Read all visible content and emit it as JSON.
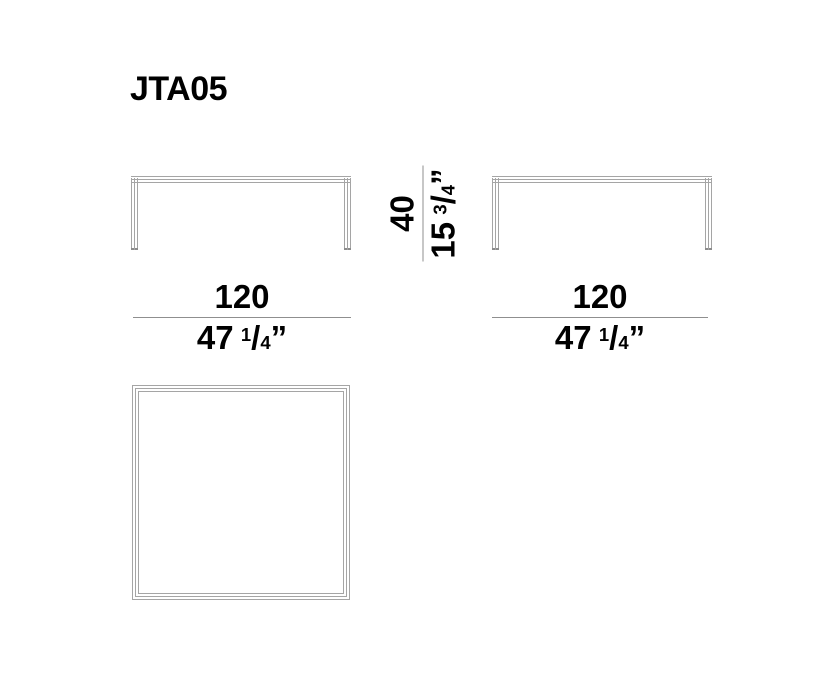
{
  "title": "JTA05",
  "dimensions": {
    "front_width": {
      "cm": "120",
      "inch_whole": "47",
      "inch_frac_num": "1",
      "inch_frac_den": "4",
      "inch_mark": "”"
    },
    "side_width": {
      "cm": "120",
      "inch_whole": "47",
      "inch_frac_num": "1",
      "inch_frac_den": "4",
      "inch_mark": "”"
    },
    "height": {
      "cm": "40",
      "inch_whole": "15",
      "inch_frac_num": "3",
      "inch_frac_den": "4",
      "inch_mark": "”"
    }
  },
  "glyphs": {
    "fraction_slash": "/"
  },
  "colors": {
    "line": "#a5a5a5",
    "rule": "#8f8f8f",
    "foot": "#8c8c8c",
    "text": "#000000",
    "background": "#ffffff"
  }
}
